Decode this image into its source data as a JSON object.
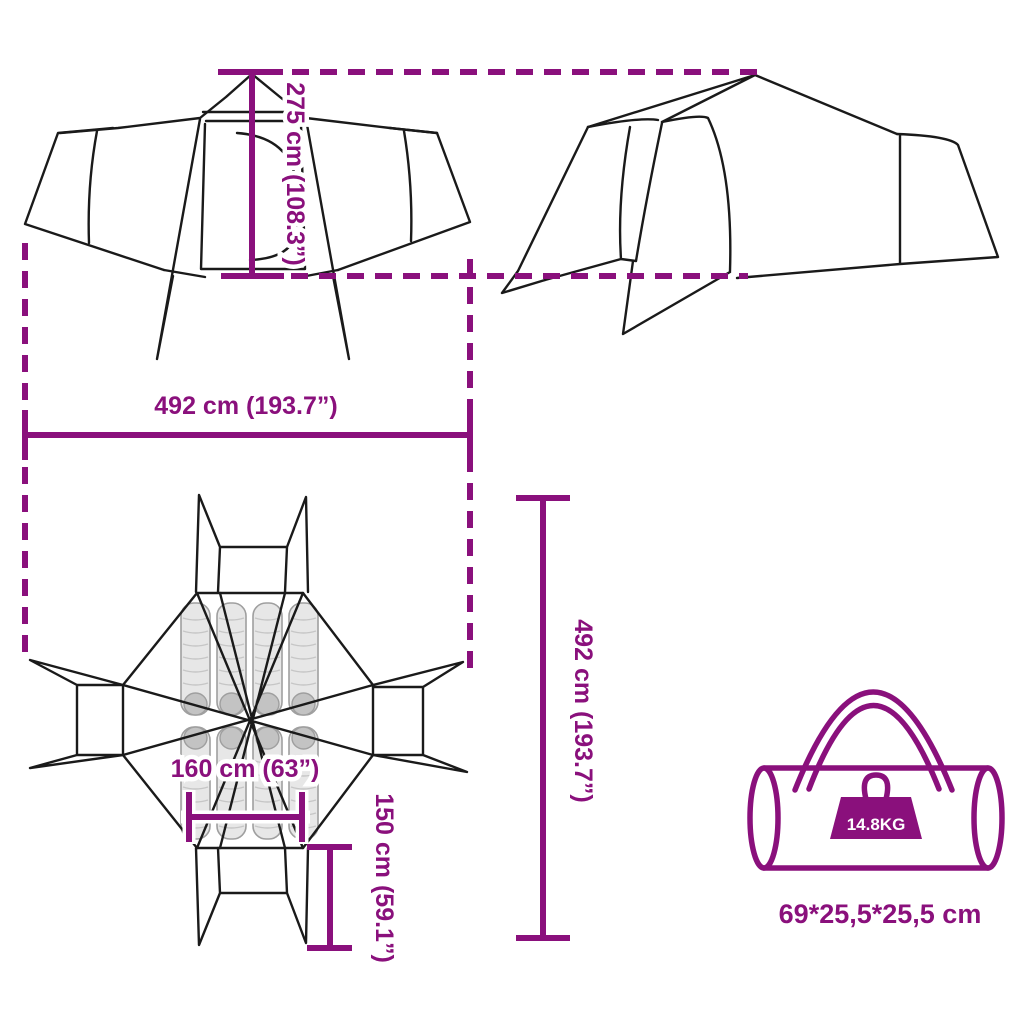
{
  "diagram": {
    "subject": "tent-dimensions-diagram",
    "colors": {
      "accent": "#8a107c",
      "line": "#1a1a1a",
      "pad_fill": "#e7e7e7",
      "pad_stripe": "#c6c6c6",
      "pillow": "#c3c3c3",
      "background": "#ffffff"
    },
    "dimensions": {
      "height_label": "275 cm (108.3”)",
      "width_label": "492 cm (193.7”)",
      "length_label": "492 cm (193.7”)",
      "inner_width_label": "160 cm (63”)",
      "vestibule_depth_label": "150 cm (59.1”)"
    },
    "package": {
      "weight_label": "14.8KG",
      "size_label": "69*25,5*25,5 cm"
    }
  }
}
